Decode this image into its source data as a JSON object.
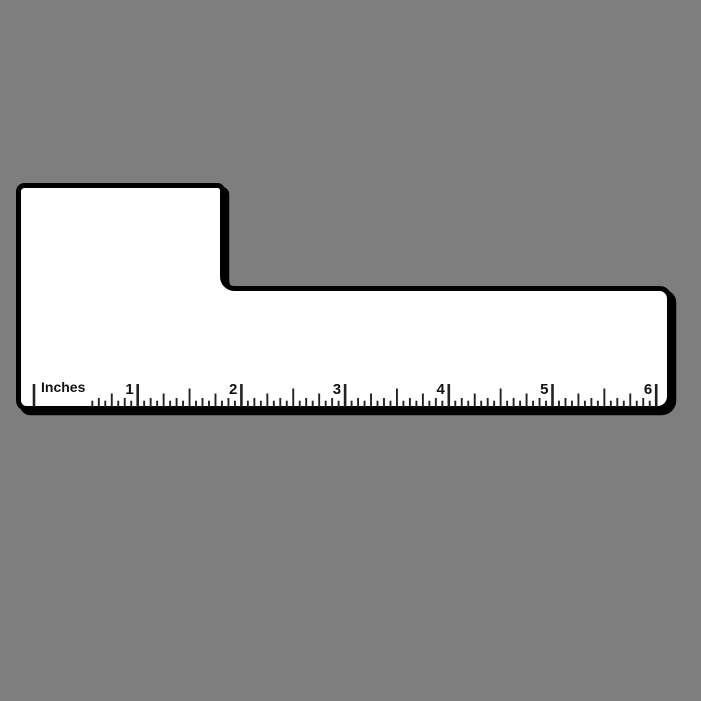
{
  "background": {
    "color": "#7e7e7e"
  },
  "ruler": {
    "unit_label": "Inches",
    "inch_labels": [
      "1",
      "2",
      "3",
      "4",
      "5",
      "6"
    ],
    "length_inches": 6,
    "divisions_per_inch": 16,
    "colors": {
      "fill": "#ffffff",
      "outline": "#000000",
      "shadow": "#000000",
      "tick": "#222222",
      "text": "#111111"
    },
    "scale": {
      "origin_x": 34,
      "inch_px": 103.7,
      "tick_bottom_y": 407,
      "tick_heights": {
        "inch": 23,
        "half": 18.5,
        "quarter": 13.5,
        "eighth": 9,
        "sixteenth": 6.3
      },
      "tick_width": 1.9,
      "inch_tick_width": 2.6,
      "label_gap_skip_from": 1,
      "label_gap_skip_to": 8,
      "number_baseline_y": 394,
      "number_offset_px": 4,
      "unit_label_x": 41,
      "unit_label_baseline_y": 392
    }
  }
}
